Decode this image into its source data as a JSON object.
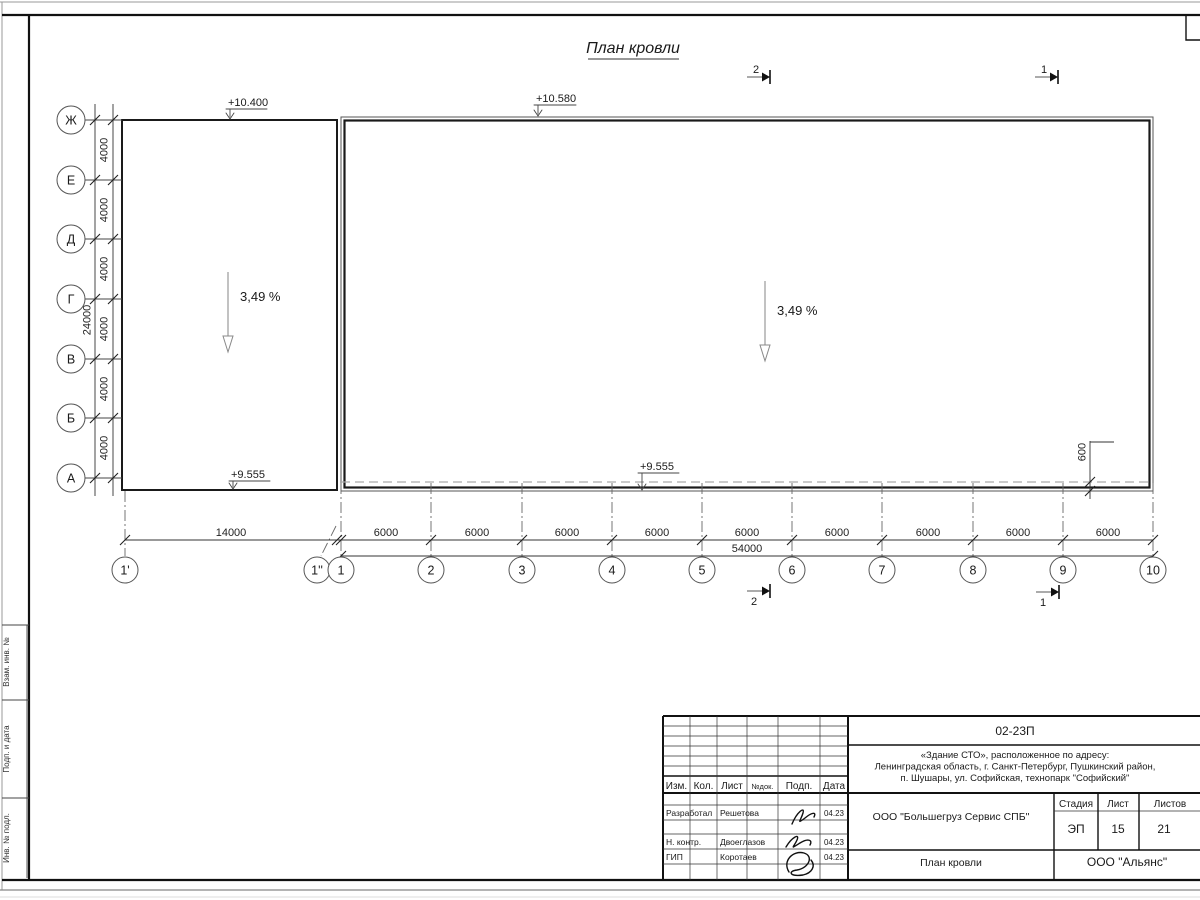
{
  "drawing": {
    "title": "План кровли",
    "slope_left": "3,49 %",
    "slope_right": "3,49 %",
    "elev_top_left": "+10.400",
    "elev_top_right": "+10.580",
    "elev_bottom_left": "+9.555",
    "elev_bottom_right": "+9.555",
    "parapet_offset": "600"
  },
  "axes": {
    "rows": [
      "Ж",
      "Е",
      "Д",
      "Г",
      "В",
      "Б",
      "А"
    ],
    "cols": [
      "1'",
      "1''",
      "1",
      "2",
      "3",
      "4",
      "5",
      "6",
      "7",
      "8",
      "9",
      "10"
    ]
  },
  "dims": {
    "row_bays": [
      "4000",
      "4000",
      "4000",
      "4000",
      "4000",
      "4000"
    ],
    "row_total": "24000",
    "col_first": "14000",
    "col_bays": [
      "6000",
      "6000",
      "6000",
      "6000",
      "6000",
      "6000",
      "6000",
      "6000",
      "6000"
    ],
    "col_total": "54000"
  },
  "sections": {
    "top_2": "2",
    "top_1": "1",
    "bottom_2": "2",
    "bottom_1": "1"
  },
  "side_strip": [
    "Взам. инв. №",
    "Подп. и дата",
    "Инв. № подл."
  ],
  "stamp": {
    "doc_number": "02-23П",
    "object_line1": "«Здание СТО», расположенное по адресу:",
    "object_line2": "Ленинградская область, г. Санкт-Петербург, Пушкинский район,",
    "object_line3": "п. Шушары, ул. Софийская, технопарк \"Софийский\"",
    "cols": {
      "izm": "Изм.",
      "kol": "Кол.",
      "list": "Лист",
      "ndok": "№док.",
      "podp": "Подп.",
      "data": "Дата"
    },
    "rows": [
      {
        "role": "Разработал",
        "name": "Решетова",
        "date": "04.23"
      },
      {
        "role": "Н. контр.",
        "name": "Двоеглазов",
        "date": "04.23"
      },
      {
        "role": "ГИП",
        "name": "Коротаев",
        "date": "04.23"
      }
    ],
    "company": "ООО \"Большегруз Сервис СПБ\"",
    "stage_label": "Стадия",
    "sheet_label": "Лист",
    "sheets_label": "Листов",
    "stage": "ЭП",
    "sheet": "15",
    "sheets": "21",
    "drawing_name": "План кровли",
    "org": "ООО \"Альянс\""
  }
}
